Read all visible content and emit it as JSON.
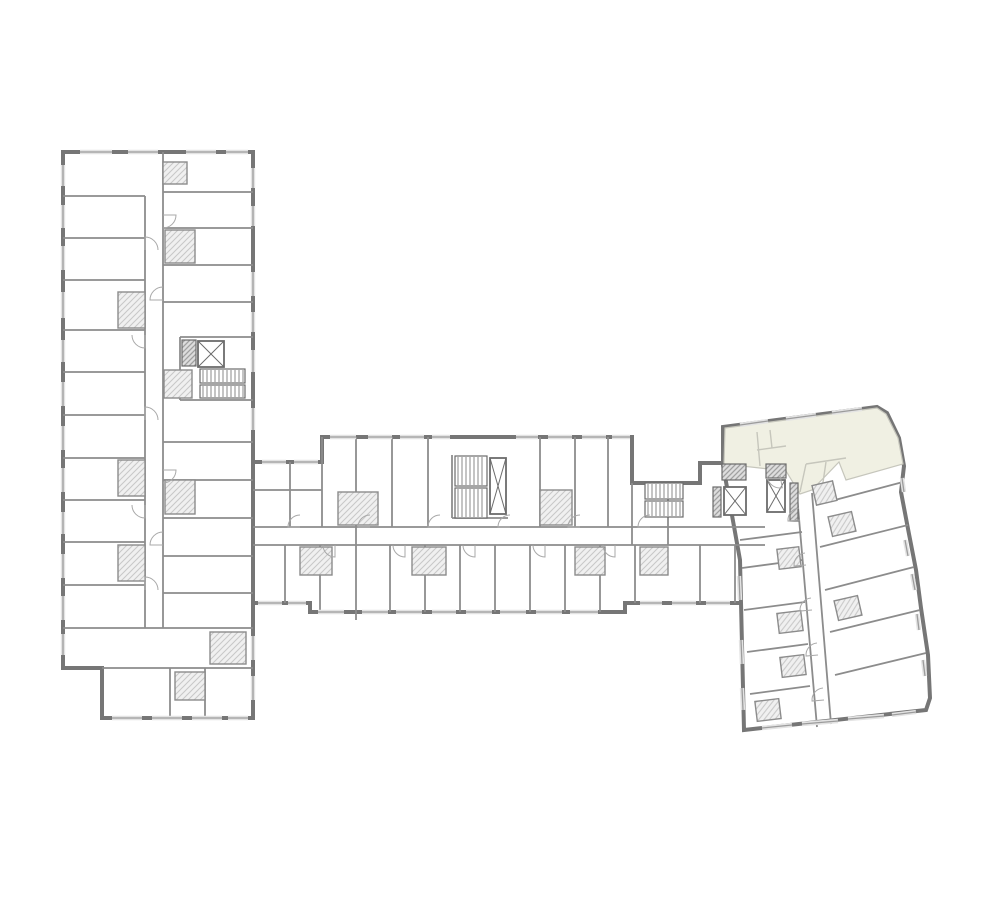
{
  "app": {
    "title": ""
  },
  "colors": {
    "background": "#ffffff",
    "wall_outer": "#767676",
    "wall_inner": "#8c8c8c",
    "wall_dark": "#6b6b6b",
    "light_line": "#c6c6bc",
    "highlight_fill": "#f0f0e3",
    "hatch_line": "#c7c7c7",
    "hatch_bg": "#f0f0f0",
    "core_hatch_line": "#a0a0a0",
    "core_hatch_bg": "#dddddd",
    "window_light": "#e3e3e3",
    "window_line": "#9c9c9c",
    "door_line": "#a8a8a8"
  },
  "floorplan": {
    "canvas": {
      "width": 1000,
      "height": 900
    },
    "wings": [
      {
        "id": "left-wing",
        "outline": [
          [
            63,
            152
          ],
          [
            253,
            152
          ],
          [
            253,
            718
          ],
          [
            102,
            718
          ],
          [
            102,
            668
          ],
          [
            63,
            668
          ]
        ]
      },
      {
        "id": "central-bar",
        "outline": [
          [
            253,
            462
          ],
          [
            322,
            462
          ],
          [
            322,
            437
          ],
          [
            632,
            437
          ],
          [
            632,
            483
          ],
          [
            700,
            483
          ],
          [
            700,
            463
          ],
          [
            765,
            463
          ],
          [
            765,
            603
          ],
          [
            625,
            603
          ],
          [
            625,
            612
          ],
          [
            310,
            612
          ],
          [
            310,
            603
          ],
          [
            253,
            603
          ]
        ]
      },
      {
        "id": "right-wing",
        "outline": [
          [
            723,
            427
          ],
          [
            877,
            407
          ],
          [
            887,
            413
          ],
          [
            899,
            438
          ],
          [
            904,
            466
          ],
          [
            901,
            492
          ],
          [
            909,
            534
          ],
          [
            916,
            570
          ],
          [
            921,
            608
          ],
          [
            928,
            655
          ],
          [
            930,
            698
          ],
          [
            926,
            710
          ],
          [
            744,
            730
          ],
          [
            740,
            560
          ],
          [
            723,
            465
          ]
        ]
      }
    ],
    "highlighted_unit": {
      "outline": [
        [
          725,
          428
        ],
        [
          877,
          408
        ],
        [
          886,
          414
        ],
        [
          898,
          438
        ],
        [
          903,
          464
        ],
        [
          846,
          480
        ],
        [
          839,
          462
        ],
        [
          812,
          490
        ],
        [
          800,
          494
        ],
        [
          786,
          471
        ],
        [
          724,
          464
        ]
      ],
      "inner_lines": [
        [
          757,
          432,
          760,
          466
        ],
        [
          757,
          450,
          786,
          446
        ],
        [
          800,
          492,
          806,
          464
        ],
        [
          806,
          464,
          846,
          458
        ],
        [
          822,
          489,
          826,
          462
        ],
        [
          770,
          430,
          772,
          448
        ]
      ]
    },
    "partitions": [
      [
        63,
        196,
        145,
        196
      ],
      [
        63,
        238,
        145,
        238
      ],
      [
        63,
        280,
        145,
        280
      ],
      [
        63,
        330,
        145,
        330
      ],
      [
        63,
        372,
        145,
        372
      ],
      [
        63,
        415,
        145,
        415
      ],
      [
        63,
        458,
        145,
        458
      ],
      [
        63,
        500,
        145,
        500
      ],
      [
        63,
        542,
        145,
        542
      ],
      [
        63,
        585,
        145,
        585
      ],
      [
        63,
        628,
        253,
        628
      ],
      [
        102,
        668,
        253,
        668
      ],
      [
        145,
        196,
        145,
        628
      ],
      [
        163,
        152,
        163,
        628
      ],
      [
        163,
        192,
        253,
        192
      ],
      [
        163,
        228,
        253,
        228
      ],
      [
        163,
        265,
        253,
        265
      ],
      [
        163,
        302,
        253,
        302
      ],
      [
        180,
        337,
        253,
        337
      ],
      [
        180,
        337,
        180,
        400
      ],
      [
        180,
        400,
        253,
        400
      ],
      [
        163,
        442,
        253,
        442
      ],
      [
        163,
        480,
        253,
        480
      ],
      [
        163,
        518,
        253,
        518
      ],
      [
        163,
        556,
        253,
        556
      ],
      [
        163,
        593,
        253,
        593
      ],
      [
        170,
        668,
        170,
        718
      ],
      [
        205,
        668,
        205,
        718
      ],
      [
        290,
        462,
        290,
        527
      ],
      [
        322,
        437,
        322,
        527
      ],
      [
        356,
        437,
        356,
        620
      ],
      [
        392,
        437,
        392,
        527
      ],
      [
        428,
        437,
        428,
        527
      ],
      [
        452,
        455,
        452,
        518
      ],
      [
        452,
        518,
        508,
        518
      ],
      [
        540,
        437,
        540,
        527
      ],
      [
        575,
        437,
        575,
        527
      ],
      [
        608,
        437,
        608,
        527
      ],
      [
        632,
        483,
        632,
        545
      ],
      [
        253,
        490,
        322,
        490
      ],
      [
        253,
        527,
        765,
        527
      ],
      [
        253,
        545,
        765,
        545
      ],
      [
        285,
        545,
        285,
        603
      ],
      [
        320,
        545,
        320,
        612
      ],
      [
        390,
        545,
        390,
        612
      ],
      [
        425,
        545,
        425,
        612
      ],
      [
        460,
        545,
        460,
        612
      ],
      [
        495,
        545,
        495,
        612
      ],
      [
        530,
        545,
        530,
        612
      ],
      [
        565,
        545,
        565,
        612
      ],
      [
        600,
        545,
        600,
        612
      ],
      [
        635,
        545,
        635,
        603
      ],
      [
        668,
        483,
        668,
        545
      ],
      [
        700,
        545,
        700,
        603
      ],
      [
        735,
        545,
        735,
        603
      ],
      [
        797,
        495,
        817,
        727
      ],
      [
        812,
        493,
        831,
        724
      ],
      [
        816,
        505,
        903,
        482
      ],
      [
        820,
        547,
        908,
        525
      ],
      [
        825,
        590,
        914,
        567
      ],
      [
        830,
        632,
        920,
        610
      ],
      [
        835,
        675,
        926,
        653
      ],
      [
        740,
        540,
        802,
        532
      ],
      [
        742,
        568,
        802,
        560
      ],
      [
        744,
        610,
        805,
        602
      ],
      [
        747,
        652,
        808,
        644
      ],
      [
        750,
        694,
        810,
        686
      ]
    ],
    "bathrooms": [
      {
        "x": 163,
        "y": 162,
        "w": 24,
        "h": 22,
        "rot": 0
      },
      {
        "x": 165,
        "y": 230,
        "w": 30,
        "h": 33,
        "rot": 0
      },
      {
        "x": 118,
        "y": 292,
        "w": 27,
        "h": 36,
        "rot": 0
      },
      {
        "x": 164,
        "y": 370,
        "w": 28,
        "h": 28,
        "rot": 0
      },
      {
        "x": 118,
        "y": 460,
        "w": 27,
        "h": 36,
        "rot": 0
      },
      {
        "x": 165,
        "y": 480,
        "w": 30,
        "h": 34,
        "rot": 0
      },
      {
        "x": 118,
        "y": 545,
        "w": 27,
        "h": 36,
        "rot": 0
      },
      {
        "x": 210,
        "y": 632,
        "w": 36,
        "h": 32,
        "rot": 0
      },
      {
        "x": 175,
        "y": 672,
        "w": 30,
        "h": 28,
        "rot": 0
      },
      {
        "x": 338,
        "y": 492,
        "w": 40,
        "h": 33,
        "rot": 0
      },
      {
        "x": 300,
        "y": 547,
        "w": 32,
        "h": 28,
        "rot": 0
      },
      {
        "x": 412,
        "y": 547,
        "w": 34,
        "h": 28,
        "rot": 0
      },
      {
        "x": 540,
        "y": 490,
        "w": 32,
        "h": 35,
        "rot": 0
      },
      {
        "x": 575,
        "y": 547,
        "w": 30,
        "h": 28,
        "rot": 0
      },
      {
        "x": 640,
        "y": 547,
        "w": 28,
        "h": 28,
        "rot": 0
      },
      {
        "x": 814,
        "y": 483,
        "w": 21,
        "h": 20,
        "rot": -13
      },
      {
        "x": 830,
        "y": 514,
        "w": 24,
        "h": 20,
        "rot": -13
      },
      {
        "x": 836,
        "y": 598,
        "w": 24,
        "h": 20,
        "rot": -13
      },
      {
        "x": 778,
        "y": 548,
        "w": 22,
        "h": 20,
        "rot": -7
      },
      {
        "x": 778,
        "y": 612,
        "w": 24,
        "h": 20,
        "rot": -7
      },
      {
        "x": 781,
        "y": 656,
        "w": 24,
        "h": 20,
        "rot": -7
      },
      {
        "x": 756,
        "y": 700,
        "w": 24,
        "h": 20,
        "rot": -7
      }
    ],
    "core_hatch_walls": [
      {
        "x": 182,
        "y": 340,
        "w": 14,
        "h": 26
      },
      {
        "x": 722,
        "y": 464,
        "w": 24,
        "h": 16
      },
      {
        "x": 766,
        "y": 464,
        "w": 20,
        "h": 14
      },
      {
        "x": 790,
        "y": 483,
        "w": 8,
        "h": 38
      },
      {
        "x": 713,
        "y": 487,
        "w": 8,
        "h": 30
      }
    ],
    "stairs": [
      {
        "x": 200,
        "y": 369,
        "w": 45,
        "h": 14
      },
      {
        "x": 200,
        "y": 385,
        "w": 45,
        "h": 13
      },
      {
        "x": 455,
        "y": 456,
        "w": 32,
        "h": 30
      },
      {
        "x": 455,
        "y": 488,
        "w": 32,
        "h": 30
      },
      {
        "x": 645,
        "y": 483,
        "w": 38,
        "h": 16
      },
      {
        "x": 645,
        "y": 501,
        "w": 38,
        "h": 16
      }
    ],
    "elevators": [
      {
        "x": 198,
        "y": 341,
        "w": 26,
        "h": 26
      },
      {
        "x": 490,
        "y": 458,
        "w": 16,
        "h": 56
      },
      {
        "x": 724,
        "y": 487,
        "w": 22,
        "h": 28
      },
      {
        "x": 767,
        "y": 480,
        "w": 18,
        "h": 32
      }
    ],
    "windows": [
      [
        63,
        165,
        63,
        186
      ],
      [
        63,
        205,
        63,
        228
      ],
      [
        63,
        246,
        63,
        270
      ],
      [
        63,
        292,
        63,
        318
      ],
      [
        63,
        340,
        63,
        362
      ],
      [
        63,
        382,
        63,
        406
      ],
      [
        63,
        426,
        63,
        450
      ],
      [
        63,
        468,
        63,
        492
      ],
      [
        63,
        512,
        63,
        534
      ],
      [
        63,
        554,
        63,
        578
      ],
      [
        63,
        596,
        63,
        620
      ],
      [
        63,
        634,
        63,
        655
      ],
      [
        80,
        152,
        112,
        152
      ],
      [
        128,
        152,
        158,
        152
      ],
      [
        186,
        152,
        216,
        152
      ],
      [
        226,
        152,
        248,
        152
      ],
      [
        253,
        168,
        253,
        188
      ],
      [
        253,
        206,
        253,
        226
      ],
      [
        253,
        272,
        253,
        296
      ],
      [
        253,
        312,
        253,
        332
      ],
      [
        253,
        350,
        253,
        372
      ],
      [
        253,
        408,
        253,
        430
      ],
      [
        253,
        636,
        253,
        660
      ],
      [
        253,
        676,
        253,
        700
      ],
      [
        112,
        718,
        142,
        718
      ],
      [
        152,
        718,
        182,
        718
      ],
      [
        192,
        718,
        222,
        718
      ],
      [
        228,
        718,
        248,
        718
      ],
      [
        330,
        437,
        356,
        437
      ],
      [
        368,
        437,
        392,
        437
      ],
      [
        400,
        437,
        424,
        437
      ],
      [
        432,
        437,
        450,
        437
      ],
      [
        516,
        437,
        538,
        437
      ],
      [
        548,
        437,
        572,
        437
      ],
      [
        582,
        437,
        606,
        437
      ],
      [
        612,
        437,
        630,
        437
      ],
      [
        262,
        462,
        286,
        462
      ],
      [
        294,
        462,
        318,
        462
      ],
      [
        318,
        612,
        344,
        612
      ],
      [
        362,
        612,
        388,
        612
      ],
      [
        396,
        612,
        422,
        612
      ],
      [
        432,
        612,
        456,
        612
      ],
      [
        466,
        612,
        492,
        612
      ],
      [
        500,
        612,
        526,
        612
      ],
      [
        536,
        612,
        562,
        612
      ],
      [
        570,
        612,
        598,
        612
      ],
      [
        258,
        603,
        282,
        603
      ],
      [
        288,
        603,
        306,
        603
      ],
      [
        640,
        603,
        662,
        603
      ],
      [
        672,
        603,
        696,
        603
      ],
      [
        706,
        603,
        730,
        603
      ],
      [
        740,
        425,
        768,
        421
      ],
      [
        786,
        419,
        816,
        415
      ],
      [
        832,
        413,
        862,
        409
      ],
      [
        902,
        478,
        904,
        492
      ],
      [
        905,
        540,
        908,
        556
      ],
      [
        912,
        574,
        915,
        590
      ],
      [
        917,
        614,
        919,
        630
      ],
      [
        923,
        660,
        925,
        676
      ],
      [
        762,
        728,
        792,
        725
      ],
      [
        802,
        724,
        838,
        721
      ],
      [
        848,
        719,
        884,
        716
      ],
      [
        892,
        715,
        916,
        712
      ],
      [
        739,
        576,
        740,
        600
      ],
      [
        741,
        640,
        742,
        664
      ],
      [
        742,
        688,
        743,
        710
      ]
    ],
    "doors": [
      {
        "x": 145,
        "y": 250,
        "r": 13,
        "a": 0
      },
      {
        "x": 145,
        "y": 335,
        "r": 13,
        "a": 180
      },
      {
        "x": 145,
        "y": 420,
        "r": 13,
        "a": 0
      },
      {
        "x": 145,
        "y": 505,
        "r": 13,
        "a": 180
      },
      {
        "x": 145,
        "y": 590,
        "r": 13,
        "a": 0
      },
      {
        "x": 163,
        "y": 215,
        "r": 13,
        "a": 90
      },
      {
        "x": 163,
        "y": 300,
        "r": 13,
        "a": -90
      },
      {
        "x": 163,
        "y": 470,
        "r": 13,
        "a": 90
      },
      {
        "x": 163,
        "y": 545,
        "r": 13,
        "a": -90
      },
      {
        "x": 300,
        "y": 527,
        "r": 12,
        "a": -90
      },
      {
        "x": 370,
        "y": 527,
        "r": 12,
        "a": -90
      },
      {
        "x": 440,
        "y": 527,
        "r": 12,
        "a": -90
      },
      {
        "x": 510,
        "y": 527,
        "r": 12,
        "a": -90
      },
      {
        "x": 580,
        "y": 527,
        "r": 12,
        "a": -90
      },
      {
        "x": 650,
        "y": 527,
        "r": 12,
        "a": -90
      },
      {
        "x": 335,
        "y": 545,
        "r": 12,
        "a": 180
      },
      {
        "x": 405,
        "y": 545,
        "r": 12,
        "a": 180
      },
      {
        "x": 475,
        "y": 545,
        "r": 12,
        "a": 180
      },
      {
        "x": 545,
        "y": 545,
        "r": 12,
        "a": 180
      },
      {
        "x": 615,
        "y": 545,
        "r": 12,
        "a": 180
      },
      {
        "x": 800,
        "y": 520,
        "r": 12,
        "a": -95
      },
      {
        "x": 806,
        "y": 565,
        "r": 12,
        "a": -95
      },
      {
        "x": 812,
        "y": 610,
        "r": 12,
        "a": -95
      },
      {
        "x": 818,
        "y": 655,
        "r": 12,
        "a": -95
      },
      {
        "x": 824,
        "y": 700,
        "r": 12,
        "a": -95
      },
      {
        "x": 780,
        "y": 475,
        "r": 13,
        "a": 170
      }
    ]
  }
}
